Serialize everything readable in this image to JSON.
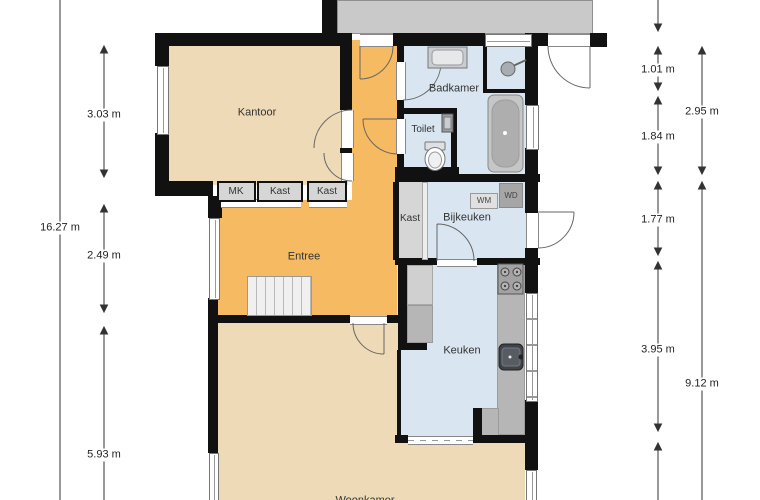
{
  "title": "Begane grond plattegrond",
  "rooms": {
    "kantoor": "Kantoor",
    "badkamer": "Badkamer",
    "toilet": "Toilet",
    "kast": "Kast",
    "bijkeuken": "Bijkeuken",
    "entree": "Entree",
    "keuken": "Keuken",
    "woonkamer": "Woonkamer"
  },
  "closets": {
    "mk": "MK",
    "kast1": "Kast",
    "kast2": "Kast"
  },
  "appliances": {
    "wm": "WM",
    "wd": "WD"
  },
  "dimensions": {
    "left_total": "16.27 m",
    "left_1": "3.03 m",
    "left_2": "2.49 m",
    "left_3": "5.93 m",
    "right_1": "1.01 m",
    "right_2": "1.84 m",
    "right_3": "1.77 m",
    "right_4": "3.95 m",
    "right_total_1": "2.95 m",
    "right_total_2": "9.12 m"
  },
  "colors": {
    "wall": "#111111",
    "room_beige": "#eedab6",
    "room_orange": "#f6bb62",
    "room_blue": "#d9e6f1",
    "outbuilding_gray": "#c9c9c9",
    "closet_gray": "#d6d6d6",
    "counter_gray": "#b6b6b6",
    "dimension_line": "#333333"
  }
}
